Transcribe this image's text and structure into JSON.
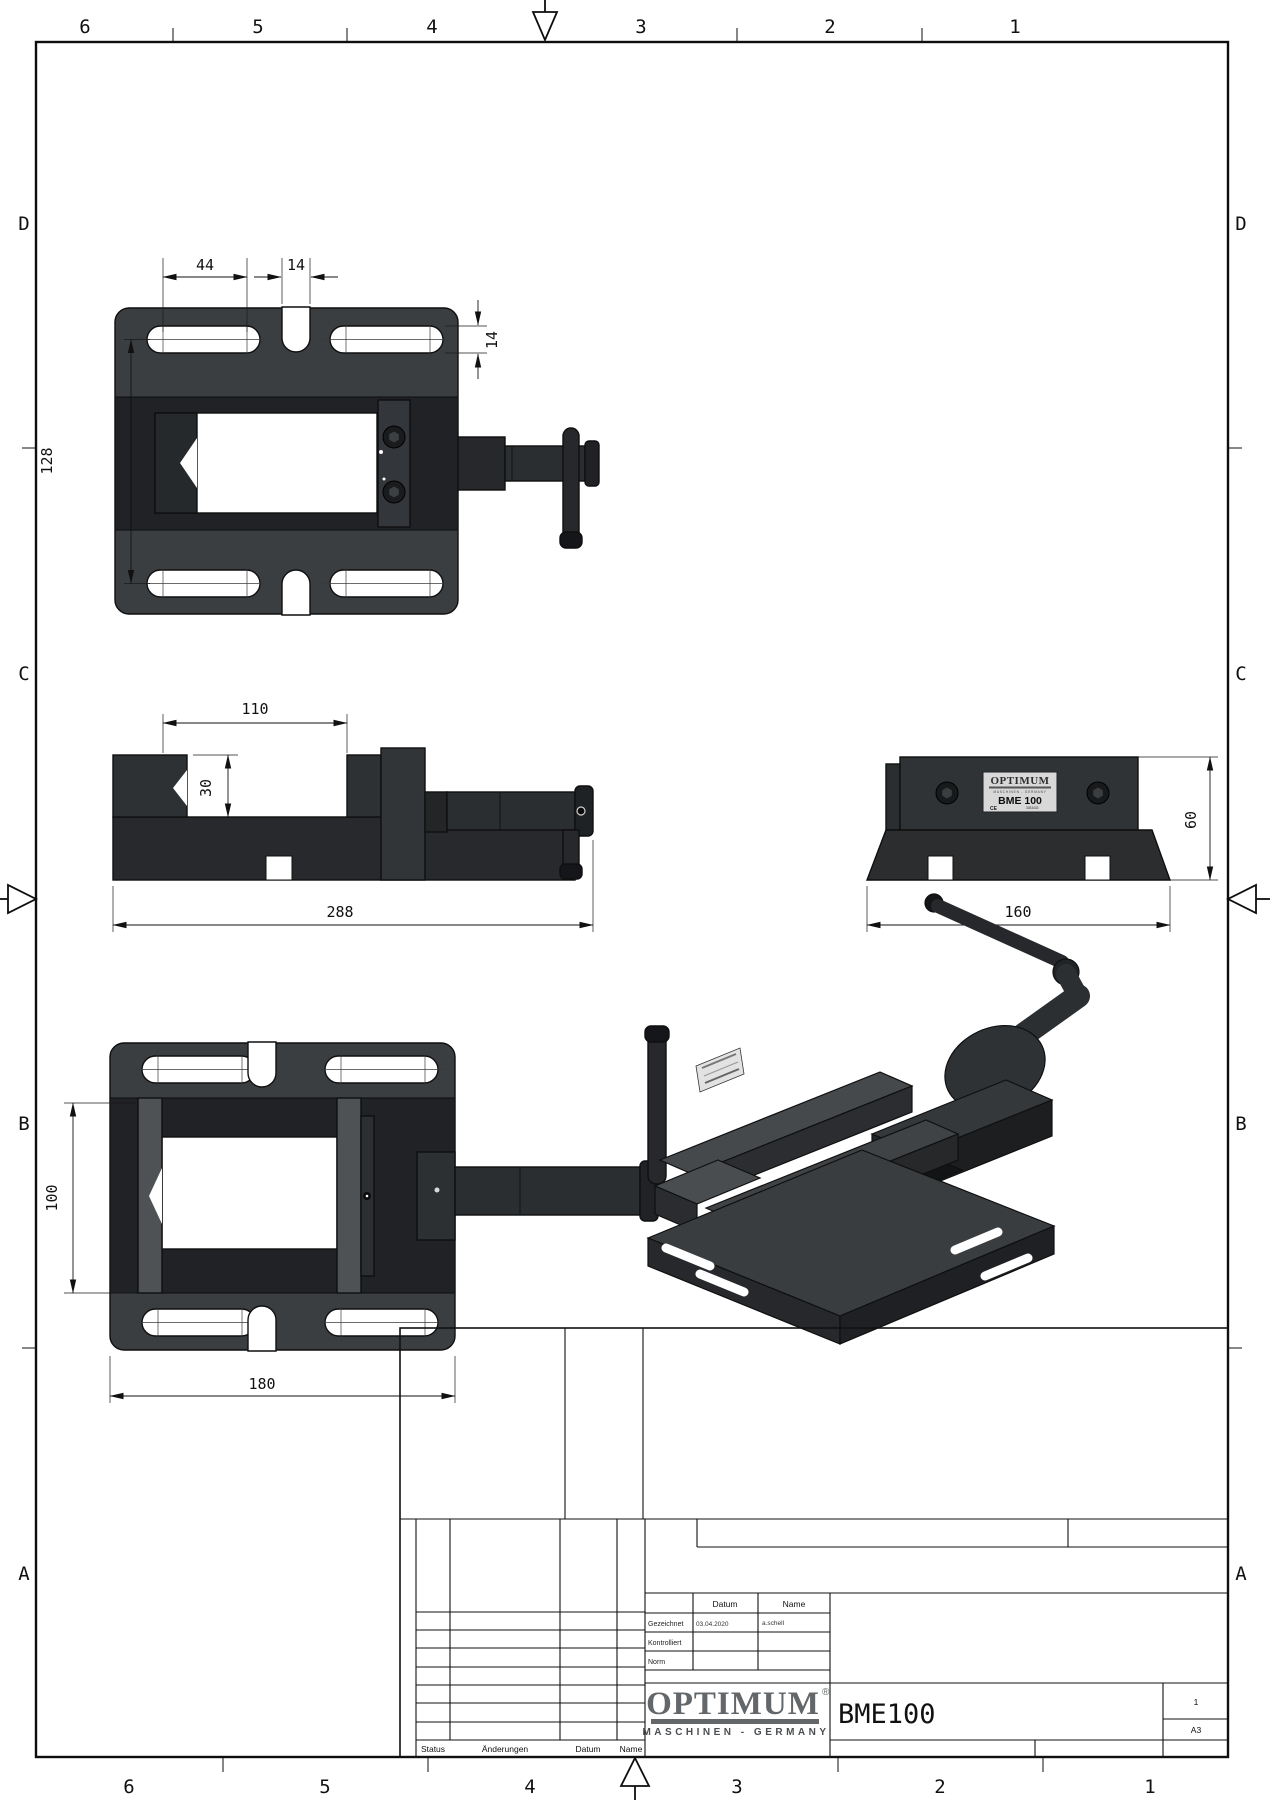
{
  "drawing": {
    "type": "engineering-drawing",
    "part_number": "BME100",
    "format": "A3",
    "sheet_no": "1"
  },
  "zones": {
    "top": [
      "6",
      "5",
      "4",
      "3",
      "2",
      "1"
    ],
    "bottom": [
      "6",
      "5",
      "4",
      "3",
      "2",
      "1"
    ],
    "left": [
      "D",
      "C",
      "B",
      "A"
    ],
    "right": [
      "D",
      "C",
      "B",
      "A"
    ]
  },
  "dimensions": {
    "slot_length": "44",
    "notch_width": "14",
    "slot_height": "14",
    "hole_row_spacing": "128",
    "jaw_opening": "110",
    "jaw_depth": "30",
    "overall_length": "288",
    "body_height": "60",
    "body_width": "160",
    "jaw_width": "100",
    "base_length": "180"
  },
  "title_block": {
    "labels": {
      "datum": "Datum",
      "name": "Name",
      "gezeichnet": "Gezeichnet",
      "kontrolliert": "Kontrolliert",
      "norm": "Norm",
      "status": "Status",
      "aenderungen": "Änderungen"
    },
    "values": {
      "drawn_date": "03.04.2020",
      "drawn_name": "a.schell"
    },
    "logo": {
      "brand": "OPTIMUM",
      "reg": "®",
      "tagline": "MASCHINEN - GERMANY"
    },
    "part_number": "BME100",
    "sheet_no": "1",
    "format": "A3"
  },
  "nameplate": {
    "brand": "OPTIMUM",
    "tagline": "MASCHINEN - GERMANY",
    "model": "BME 100",
    "ce": "CE",
    "serial": "3053433"
  },
  "colors": {
    "body_gray": "#3b3e41",
    "dark_band": "#202225",
    "line": "#111111",
    "logo_gray": "#63676a"
  }
}
